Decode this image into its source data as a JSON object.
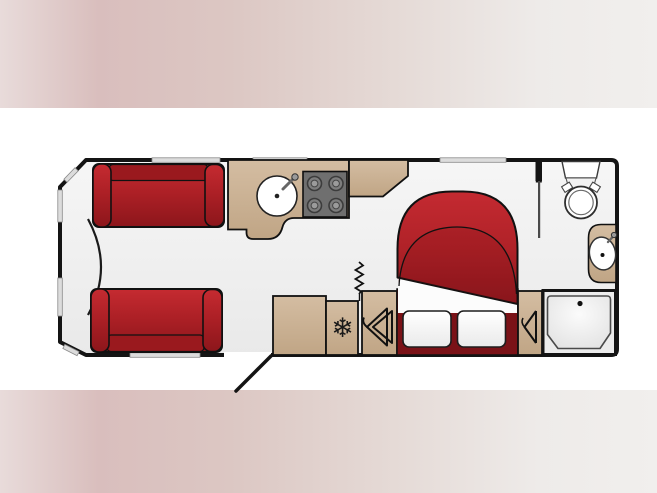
{
  "page": {
    "background": {
      "band_top": {
        "y": 0,
        "height": 108
      },
      "band_bottom": {
        "y": 390,
        "height": 103
      },
      "center_color": "#ffffff",
      "band_gradient": [
        "#e8dbda",
        "#d9bebd",
        "#dcc7c3",
        "#e5dad6",
        "#f1efed"
      ]
    }
  },
  "floorplan": {
    "type": "caravan-floorplan",
    "view": "top-down",
    "colors": {
      "outline": "#141414",
      "floor": "#f1f1f1",
      "upholstery_red": "#b02127",
      "upholstery_red_dark": "#8e171c",
      "bed_base_maroon": "#7a1217",
      "cabinet_beige": "#cbb196",
      "hob_grey": "#6f6f6f",
      "fixture_white": "#fdfdfd",
      "window_grey": "#dcdcdc"
    },
    "icons": {
      "snowflake_glyph": "❄"
    },
    "rooms": [
      {
        "name": "front-lounge",
        "fixtures": [
          "parallel-sofa-top",
          "parallel-sofa-bottom",
          "front-chest"
        ]
      },
      {
        "name": "kitchen",
        "fixtures": [
          "worktop",
          "round-sink",
          "four-burner-hob",
          "overhead-cabinet",
          "fridge",
          "entrance-door"
        ]
      },
      {
        "name": "bedroom",
        "fixtures": [
          "island-double-bed",
          "two-pillows",
          "wardrobe",
          "bedside-cabinet",
          "concertina-divider"
        ]
      },
      {
        "name": "washroom",
        "fixtures": [
          "toilet",
          "washbasin",
          "shower-tray"
        ]
      }
    ]
  }
}
